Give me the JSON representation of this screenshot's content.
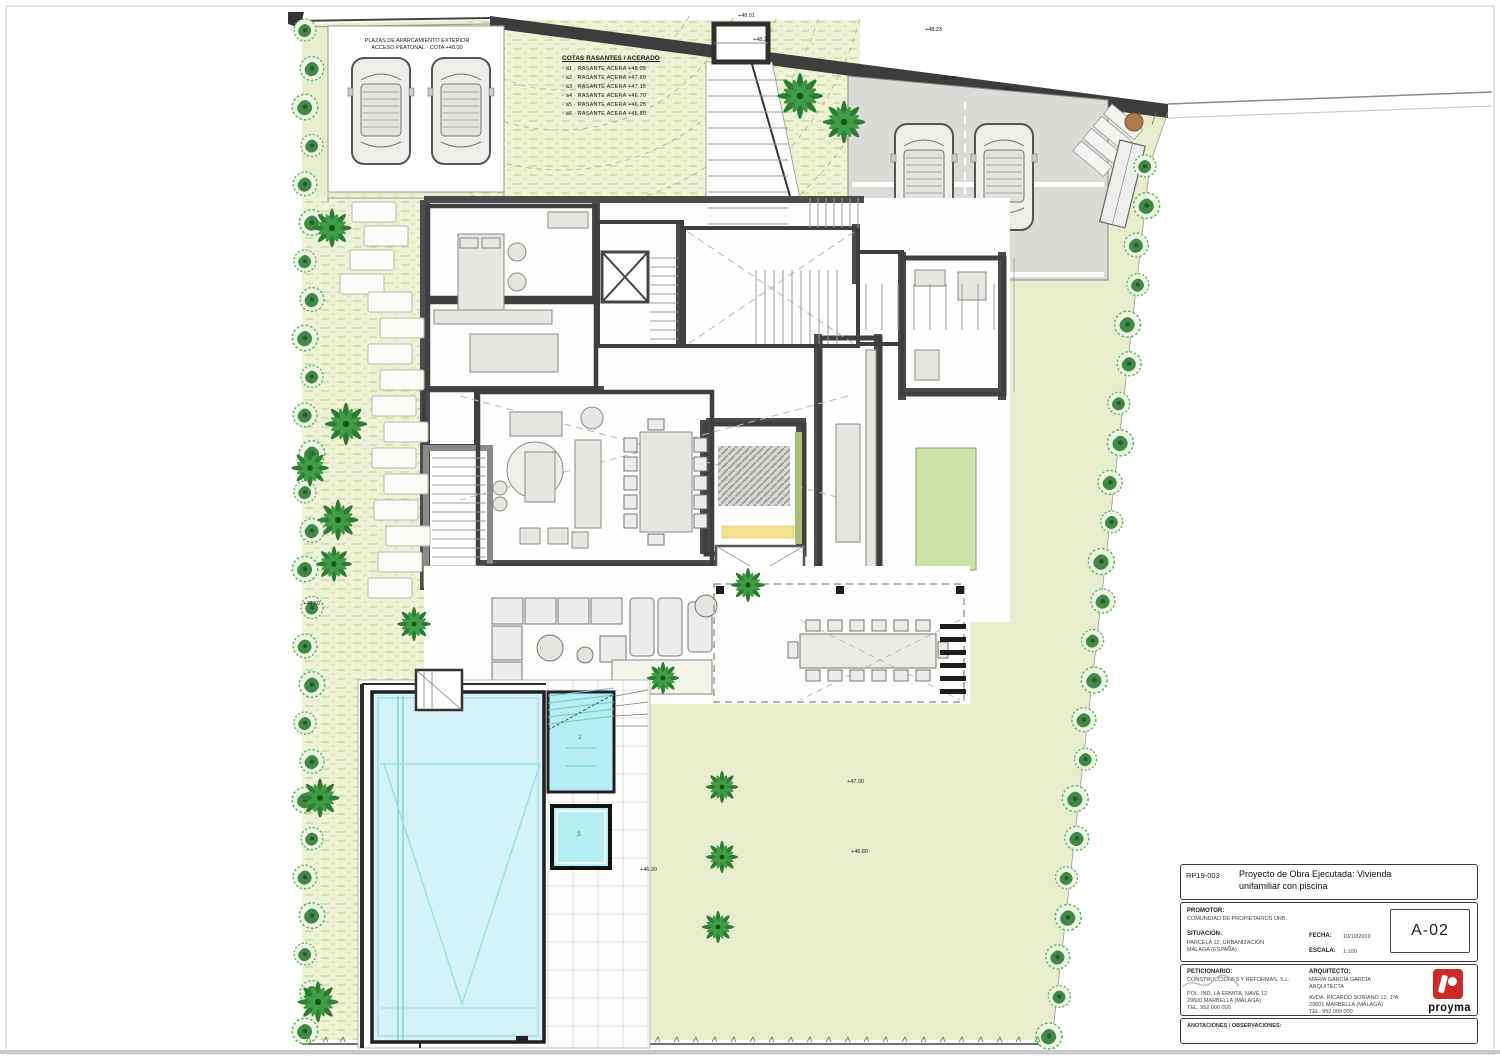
{
  "sheet": {
    "code": "RP19-003",
    "title_line1": "Proyecto de Obra Ejecutada: Vivienda",
    "title_line2": "unifamiliar con piscina",
    "number": "A-02"
  },
  "titleblock": {
    "promotor_label": "PROMOTOR:",
    "promotor_value": "COMUNIDAD DE PROPIETARIOS URB.",
    "situacion_label": "SITUACIÓN:",
    "situacion_line1": "PARCELA 12, URBANIZACIÓN",
    "situacion_line2": "MÁLAGA (ESPAÑA)",
    "fecha_label": "FECHA:",
    "fecha_value": "10/10/2019",
    "escala_label": "ESCALA:",
    "escala_value": "1:100",
    "peticionario_label": "PETICIONARIO:",
    "peticionario_line1": "CONSTRUCCIONES Y REFORMAS, S.L.",
    "peticionario_line2": "POL. IND. LA ERMITA, NAVE 12",
    "peticionario_line3": "29600 MARBELLA (MÁLAGA)",
    "peticionario_line4": "TEL. 952 000 000",
    "arquitecto_label": "ARQUITECTO:",
    "arquitecto_line1": "MARÍA GARCÍA GARCÍA",
    "arquitecto_line2": "ARQUITECTA",
    "arquitecto_line3": "AVDA. RICARDO SORIANO 12, 1ºA",
    "arquitecto_line4": "29601 MARBELLA (MÁLAGA)",
    "arquitecto_line5": "TEL. 952 000 000",
    "observaciones": "ANOTACIONES / OBSERVACIONES:",
    "logo_text": "proyma"
  },
  "legend": {
    "title": "COTAS RASANTES / ACERADO",
    "items": [
      "-  a1 · RASANTE ACERA  +48.05",
      "-  a2 · RASANTE ACERA  +47.60",
      "-  a3 · RASANTE ACERA  +47.15",
      "-  a4 · RASANTE ACERA  +46.70",
      "-  a5 · RASANTE ACERA  +46.25",
      "-  a6 · RASANTE ACERA  +45.80"
    ]
  },
  "parking_label": {
    "line1": "PLAZAS DE APARCAMIENTO EXTERIOR",
    "line2": "ACCESO PEATONAL · COTA +48.00"
  },
  "marks": [
    "+48.01",
    "+48.23",
    "+48.40",
    "+48.12",
    "+48.21",
    "+47.00",
    "+46.80",
    "+46.20",
    "+45.50"
  ],
  "pool": {
    "shallow_label": "2",
    "spa_label": "3"
  },
  "colors": {
    "lawn": "#e8eecd",
    "lawn_hatch": "#eef2d6",
    "water": "#d2f2f5",
    "water_bright": "#b5edf3",
    "wall": "#3f3f3f",
    "driveway_gray": "#dbdbd7",
    "accent_yellow": "#f2e38c",
    "logo_red": "#cf2a27",
    "tree_dark": "#2e7d32",
    "tree_light": "#3f9b45"
  }
}
